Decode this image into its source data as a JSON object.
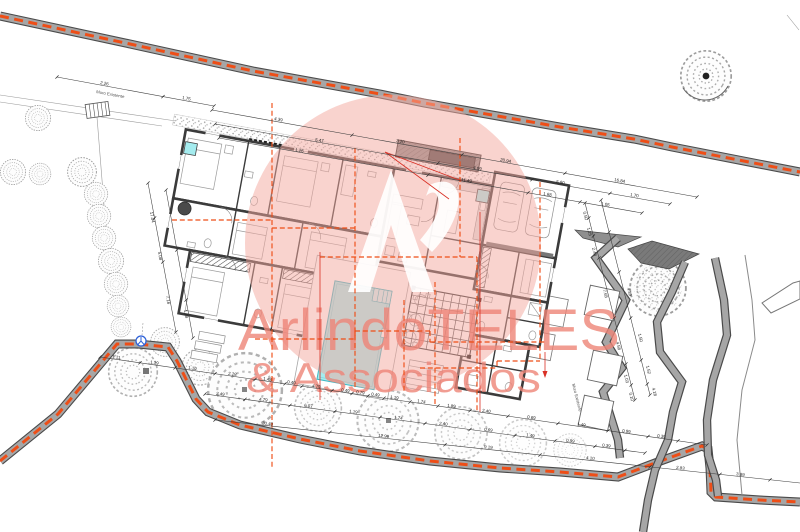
{
  "drawing": {
    "watermark": {
      "line1": "ArlindoTELES",
      "line2": "& Associados"
    },
    "annotations": {
      "wall_top": "Muro Existente",
      "wall_right": "Muro Existente"
    },
    "dimensions": {
      "top_chain1": [
        "2.26",
        "1.75"
      ],
      "top_chain2": [
        "4.39",
        "3.20",
        "20.94",
        "16.84"
      ],
      "top_chain3": [
        "5.47",
        "4.09",
        "5.90",
        "1.70"
      ],
      "top_chain4": [
        "1.26",
        "11.49",
        "1.68",
        "1.05"
      ],
      "left_chain1": [
        "17.04",
        "5.08",
        "7.16"
      ],
      "left_chain2": [
        "1.18"
      ],
      "bottom_chain1": [
        "1.11",
        "1.19",
        "1.10",
        "2.28",
        "1.48",
        "0.40",
        "4.79",
        "0.49",
        "0.79",
        "0.49",
        "1.19",
        "1.74",
        "1.89",
        "2.40",
        "0.69",
        "1.49",
        "0.99",
        "0.39"
      ],
      "bottom_chain2": [
        "2.49",
        "4.79",
        "6.07",
        "1.19",
        "1.74",
        "2.40",
        "0.69",
        "1.49",
        "0.99",
        "0.39"
      ],
      "bottom_chain3": [
        "30.40",
        "12.99",
        "9.19",
        "4.10",
        "2.83",
        "3.89"
      ],
      "right_chain1": [
        "0.50",
        "1.25",
        "2.48",
        "7.65",
        "4.58",
        "1.03",
        "0.10"
      ],
      "right_chain2": [
        "4.39",
        "1.50",
        "1.52",
        "4.18"
      ]
    },
    "colors": {
      "boundary_orange": "#ee4e17",
      "pool_cyan": "#a5ecef",
      "watermark_pink": "#f3a79e",
      "watermark_text": "#ee8578",
      "utility_blue": "#2f62d8",
      "section_red": "#d93025"
    }
  }
}
